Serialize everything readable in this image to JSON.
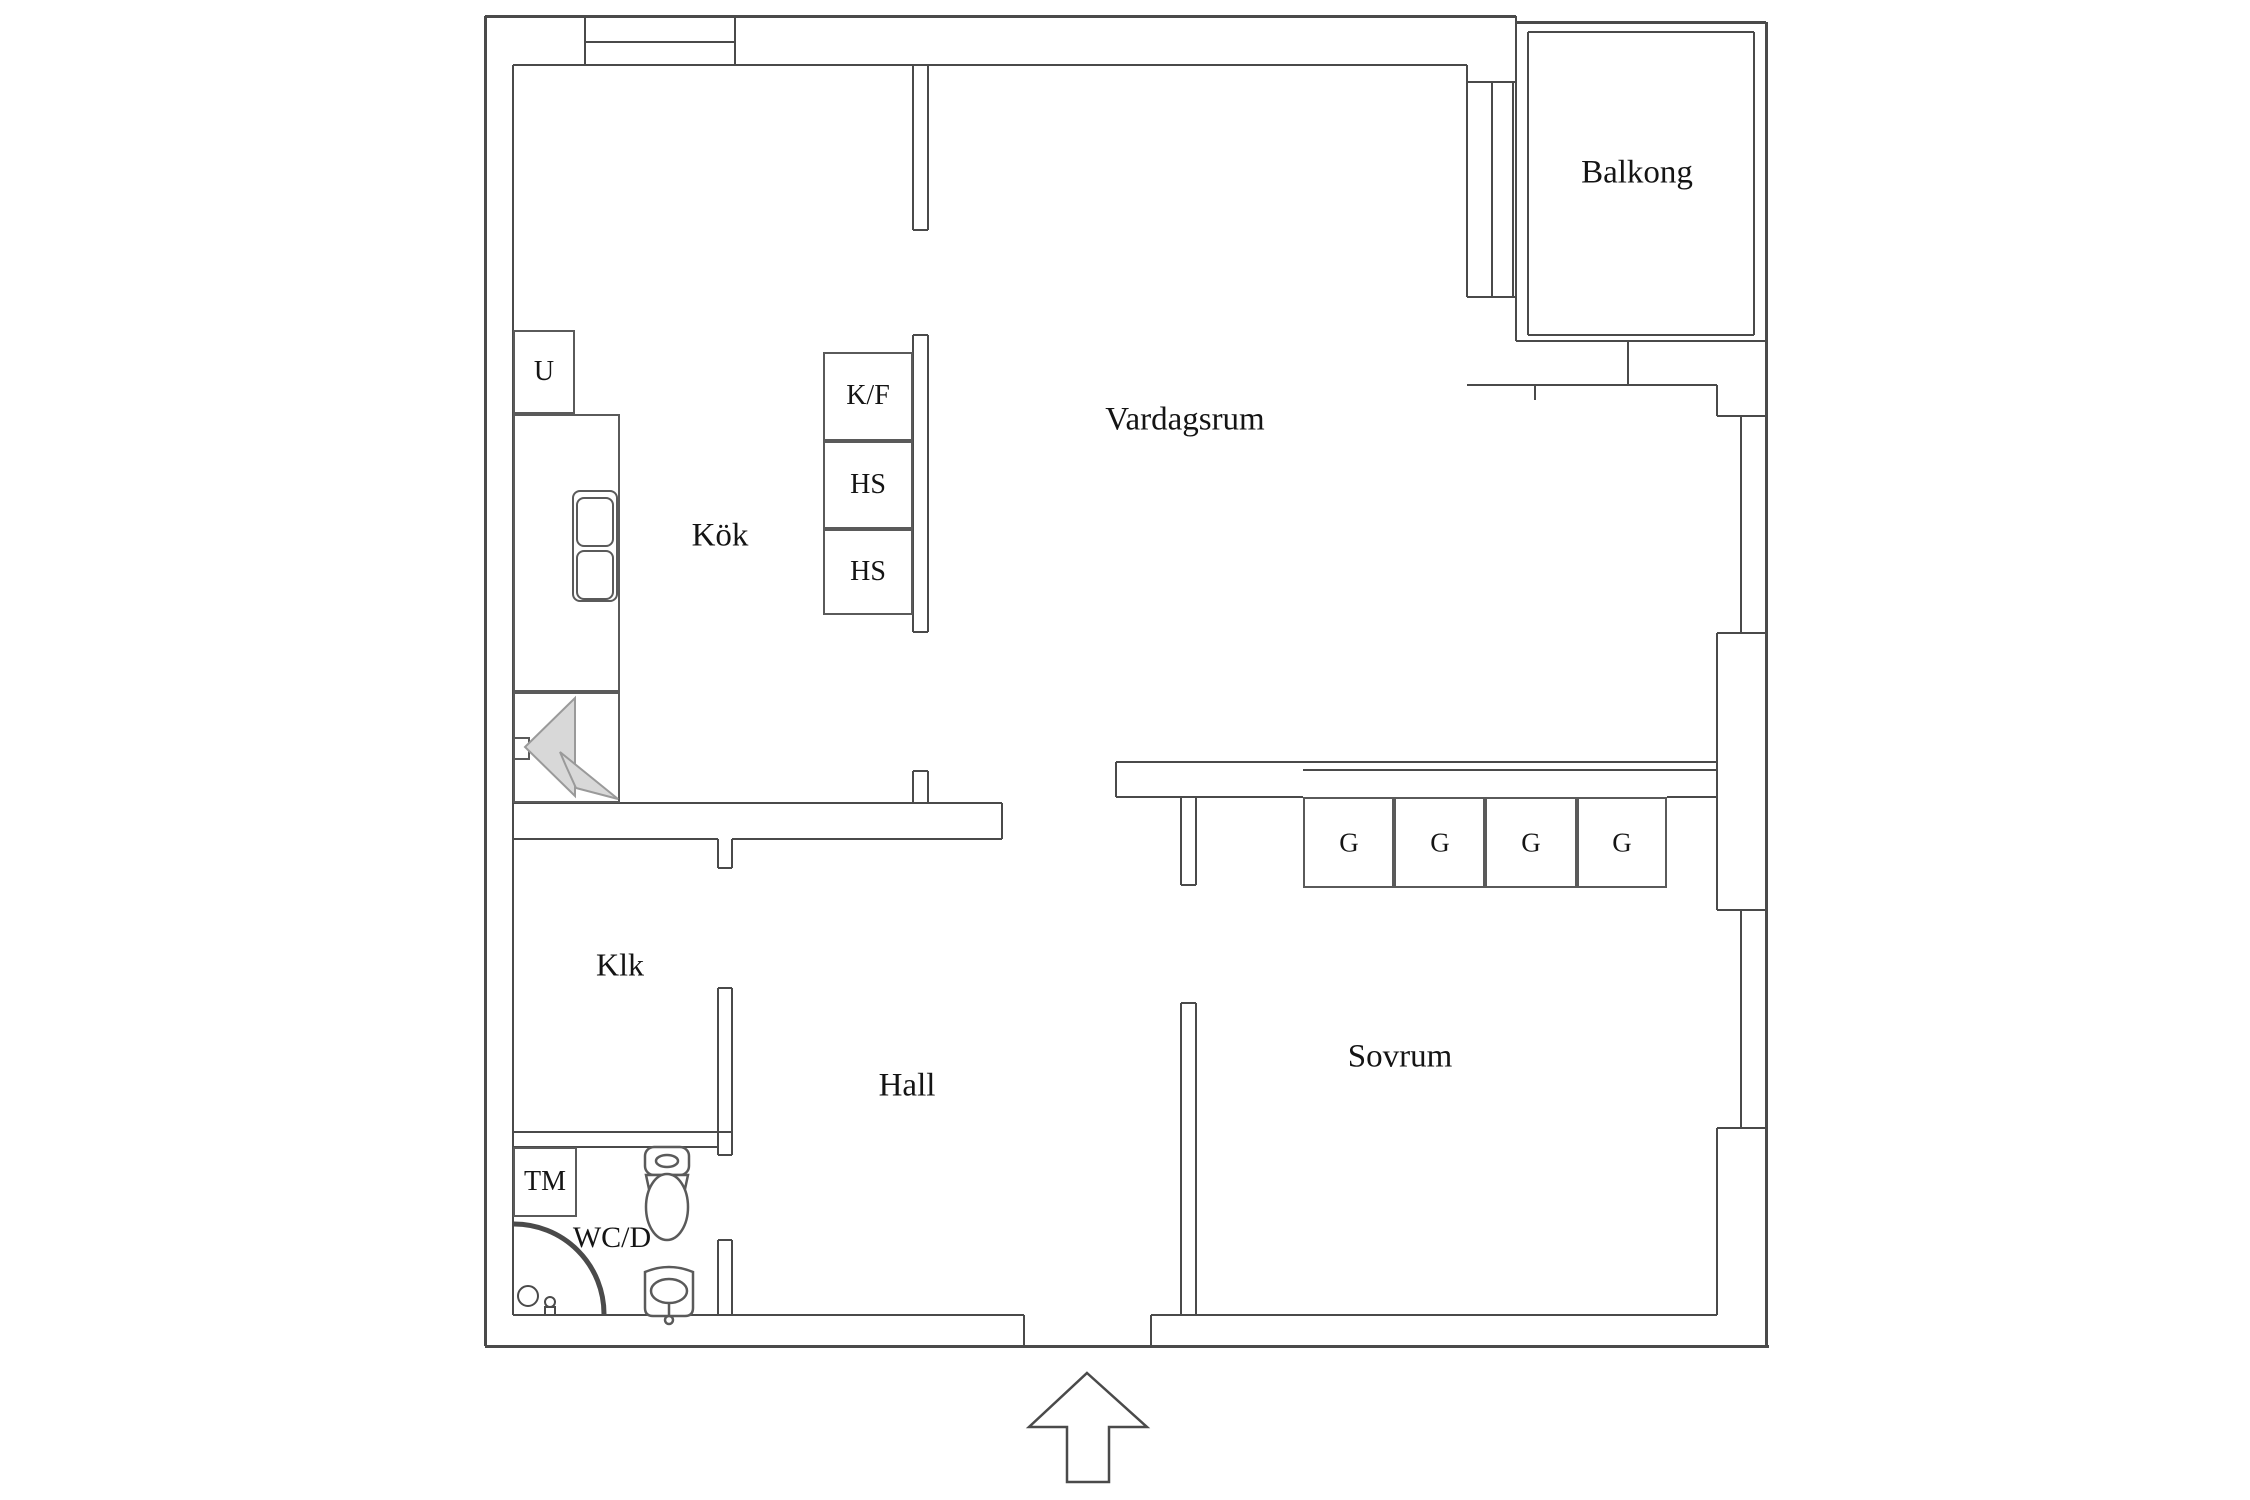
{
  "document": {
    "kind": "floor-plan",
    "background": "#ffffff"
  },
  "colors": {
    "wall_line": "#4a4a4a",
    "box_line": "#5a5a5a",
    "text": "#141414",
    "fan_fill": "#d8d8d8",
    "fan_stroke": "#9a9a9a"
  },
  "labels": [
    {
      "id": "balkong",
      "text": "Balkong",
      "x": 1637,
      "y": 173,
      "size": 33
    },
    {
      "id": "vardagsrum",
      "text": "Vardagsrum",
      "x": 1185,
      "y": 420,
      "size": 33
    },
    {
      "id": "kok",
      "text": "Kök",
      "x": 720,
      "y": 536,
      "size": 33
    },
    {
      "id": "klk",
      "text": "Klk",
      "x": 620,
      "y": 965,
      "size": 32
    },
    {
      "id": "hall",
      "text": "Hall",
      "x": 907,
      "y": 1086,
      "size": 33
    },
    {
      "id": "sovrum",
      "text": "Sovrum",
      "x": 1400,
      "y": 1057,
      "size": 33
    },
    {
      "id": "wcd",
      "text": "WC/D",
      "x": 612,
      "y": 1238,
      "size": 30
    },
    {
      "id": "tm",
      "text": "TM",
      "x": 545,
      "y": 1182,
      "size": 28
    },
    {
      "id": "u",
      "text": "U",
      "x": 544,
      "y": 372,
      "size": 28
    },
    {
      "id": "kf",
      "text": "K/F",
      "x": 868,
      "y": 396,
      "size": 28
    },
    {
      "id": "hs1",
      "text": "HS",
      "x": 868,
      "y": 485,
      "size": 28
    },
    {
      "id": "hs2",
      "text": "HS",
      "x": 868,
      "y": 572,
      "size": 28
    },
    {
      "id": "g1",
      "text": "G",
      "x": 1349,
      "y": 843,
      "size": 27
    },
    {
      "id": "g2",
      "text": "G",
      "x": 1440,
      "y": 843,
      "size": 27
    },
    {
      "id": "g3",
      "text": "G",
      "x": 1531,
      "y": 843,
      "size": 27
    },
    {
      "id": "g4",
      "text": "G",
      "x": 1622,
      "y": 843,
      "size": 27
    }
  ],
  "walls": [
    [
      485,
      16,
      1031,
      "h",
      3
    ],
    [
      513,
      65,
      954,
      "h",
      2
    ],
    [
      585,
      42,
      150,
      "h",
      2
    ],
    [
      1516,
      22,
      250,
      "h",
      3
    ],
    [
      1528,
      32,
      226,
      "h",
      2
    ],
    [
      1528,
      335,
      226,
      "h",
      2
    ],
    [
      1516,
      341,
      250,
      "h",
      2
    ],
    [
      1467,
      82,
      49,
      "h",
      2
    ],
    [
      1467,
      297,
      49,
      "h",
      2
    ],
    [
      1467,
      385,
      250,
      "h",
      2
    ],
    [
      513,
      803,
      489,
      "h",
      2
    ],
    [
      513,
      839,
      205,
      "h",
      2
    ],
    [
      732,
      839,
      270,
      "h",
      2
    ],
    [
      513,
      1132,
      219,
      "h",
      2
    ],
    [
      513,
      1147,
      205,
      "h",
      2
    ],
    [
      1116,
      762,
      601,
      "h",
      2
    ],
    [
      1303,
      770,
      414,
      "h",
      2
    ],
    [
      1116,
      797,
      187,
      "h",
      2
    ],
    [
      1667,
      797,
      50,
      "h",
      2
    ],
    [
      513,
      1315,
      511,
      "h",
      2
    ],
    [
      1151,
      1315,
      566,
      "h",
      2
    ],
    [
      485,
      1346,
      1284,
      "h",
      3
    ],
    [
      1717,
      416,
      49,
      "h",
      2
    ],
    [
      1717,
      633,
      49,
      "h",
      2
    ],
    [
      1717,
      910,
      49,
      "h",
      2
    ],
    [
      1717,
      1128,
      49,
      "h",
      2
    ],
    [
      1181,
      885,
      15,
      "h",
      2
    ],
    [
      1181,
      1003,
      15,
      "h",
      2
    ],
    [
      718,
      868,
      14,
      "h",
      2
    ],
    [
      718,
      988,
      14,
      "h",
      2
    ],
    [
      718,
      1155,
      14,
      "h",
      2
    ],
    [
      718,
      1240,
      14,
      "h",
      2
    ],
    [
      913,
      230,
      15,
      "h",
      2
    ],
    [
      913,
      335,
      15,
      "h",
      2
    ],
    [
      913,
      632,
      15,
      "h",
      2
    ],
    [
      913,
      771,
      15,
      "h",
      2
    ],
    [
      485,
      16,
      1330,
      "v",
      3
    ],
    [
      513,
      65,
      1250,
      "v",
      2
    ],
    [
      585,
      16,
      49,
      "v",
      2
    ],
    [
      735,
      16,
      49,
      "v",
      2
    ],
    [
      913,
      65,
      165,
      "v",
      2
    ],
    [
      928,
      65,
      165,
      "v",
      2
    ],
    [
      913,
      335,
      297,
      "v",
      2
    ],
    [
      928,
      335,
      297,
      "v",
      2
    ],
    [
      913,
      771,
      32,
      "v",
      2
    ],
    [
      928,
      771,
      32,
      "v",
      2
    ],
    [
      1467,
      65,
      232,
      "v",
      2
    ],
    [
      1492,
      82,
      215,
      "v",
      2
    ],
    [
      1513,
      82,
      215,
      "v",
      2
    ],
    [
      1516,
      16,
      325,
      "v",
      2
    ],
    [
      1528,
      32,
      303,
      "v",
      2
    ],
    [
      1754,
      32,
      303,
      "v",
      2
    ],
    [
      1766,
      22,
      1324,
      "v",
      3
    ],
    [
      1628,
      341,
      44,
      "v",
      2
    ],
    [
      1535,
      385,
      15,
      "v",
      2
    ],
    [
      1717,
      385,
      31,
      "v",
      2
    ],
    [
      1717,
      633,
      277,
      "v",
      2
    ],
    [
      1717,
      1128,
      187,
      "v",
      2
    ],
    [
      1741,
      416,
      217,
      "v",
      2
    ],
    [
      1741,
      910,
      218,
      "v",
      2
    ],
    [
      1181,
      797,
      88,
      "v",
      2
    ],
    [
      1196,
      797,
      88,
      "v",
      2
    ],
    [
      1181,
      1003,
      312,
      "v",
      2
    ],
    [
      1196,
      1003,
      312,
      "v",
      2
    ],
    [
      1116,
      762,
      35,
      "v",
      2
    ],
    [
      1002,
      803,
      36,
      "v",
      2
    ],
    [
      718,
      839,
      29,
      "v",
      2
    ],
    [
      732,
      839,
      29,
      "v",
      2
    ],
    [
      718,
      988,
      167,
      "v",
      2
    ],
    [
      732,
      988,
      167,
      "v",
      2
    ],
    [
      718,
      1240,
      75,
      "v",
      2
    ],
    [
      732,
      1240,
      75,
      "v",
      2
    ],
    [
      1024,
      1315,
      31,
      "v",
      2
    ],
    [
      1151,
      1315,
      31,
      "v",
      2
    ],
    [
      570,
      414,
      389,
      "v",
      2
    ]
  ],
  "boxes": [
    {
      "x": 513,
      "y": 330,
      "w": 62,
      "h": 84,
      "name": "cabinet-u"
    },
    {
      "x": 513,
      "y": 414,
      "w": 107,
      "h": 278,
      "name": "kitchen-counter"
    },
    {
      "x": 513,
      "y": 692,
      "w": 107,
      "h": 111,
      "name": "stove-area"
    },
    {
      "x": 513,
      "y": 737,
      "w": 17,
      "h": 23,
      "name": "wall-vent"
    },
    {
      "x": 572,
      "y": 490,
      "w": 46,
      "h": 112,
      "name": "kitchen-sink",
      "round": true
    },
    {
      "x": 576,
      "y": 497,
      "w": 38,
      "h": 50,
      "name": "sink-bowl-1",
      "round": true
    },
    {
      "x": 576,
      "y": 550,
      "w": 38,
      "h": 50,
      "name": "sink-bowl-2",
      "round": true
    },
    {
      "x": 823,
      "y": 352,
      "w": 90,
      "h": 89,
      "name": "cabinet-kf"
    },
    {
      "x": 823,
      "y": 441,
      "w": 90,
      "h": 88,
      "name": "cabinet-hs-1"
    },
    {
      "x": 823,
      "y": 529,
      "w": 90,
      "h": 86,
      "name": "cabinet-hs-2"
    },
    {
      "x": 513,
      "y": 1147,
      "w": 64,
      "h": 70,
      "name": "cabinet-tm"
    },
    {
      "x": 1303,
      "y": 797,
      "w": 91,
      "h": 91,
      "name": "wardrobe-g-1"
    },
    {
      "x": 1394,
      "y": 797,
      "w": 91,
      "h": 91,
      "name": "wardrobe-g-2"
    },
    {
      "x": 1485,
      "y": 797,
      "w": 92,
      "h": 91,
      "name": "wardrobe-g-3"
    },
    {
      "x": 1577,
      "y": 797,
      "w": 90,
      "h": 91,
      "name": "wardrobe-g-4"
    }
  ]
}
